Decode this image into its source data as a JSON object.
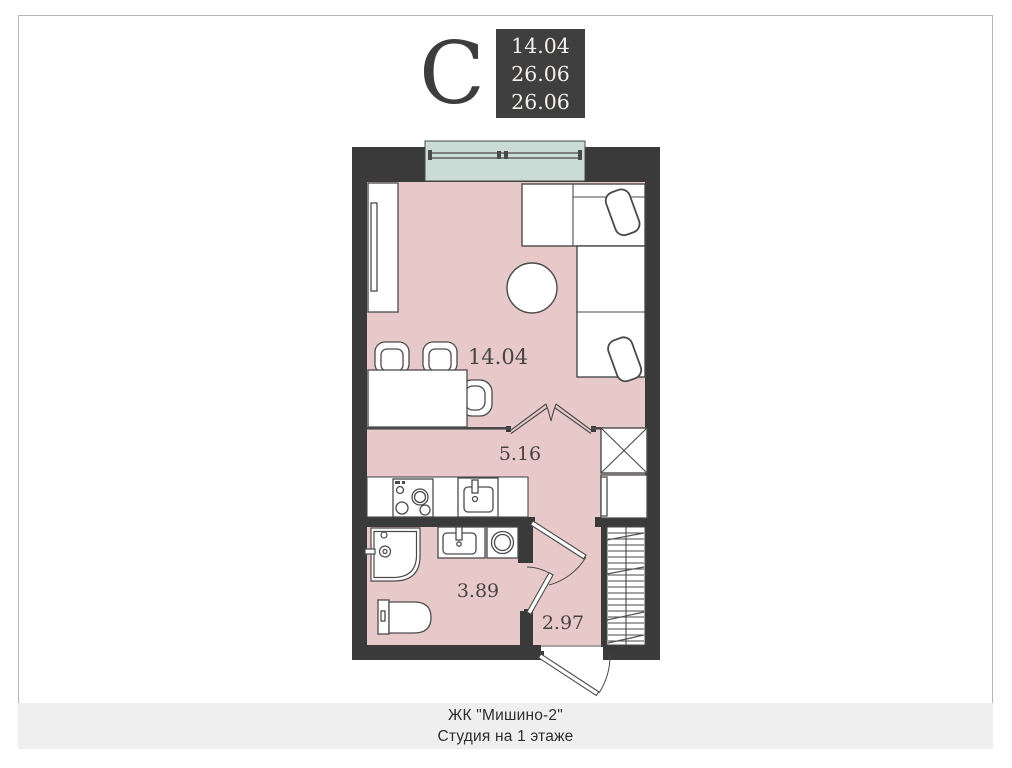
{
  "compass": {
    "letter": "С"
  },
  "area_badge": {
    "values": [
      "14.04",
      "26.06",
      "26.06"
    ]
  },
  "plan": {
    "room_labels": {
      "living": "14.04",
      "hall": "5.16",
      "bathroom": "3.89",
      "entry": "2.97"
    }
  },
  "caption": {
    "line1": "ЖК \"Мишино-2\"",
    "line2": "Студия на 1 этаже"
  },
  "colors": {
    "wall": "#3a3a3a",
    "floor": "#e7c9c9",
    "window": "#cbdbd6",
    "stroke": "#4a4a4a",
    "badge_bg": "#3f3f3f",
    "caption_bg": "#efefef"
  }
}
